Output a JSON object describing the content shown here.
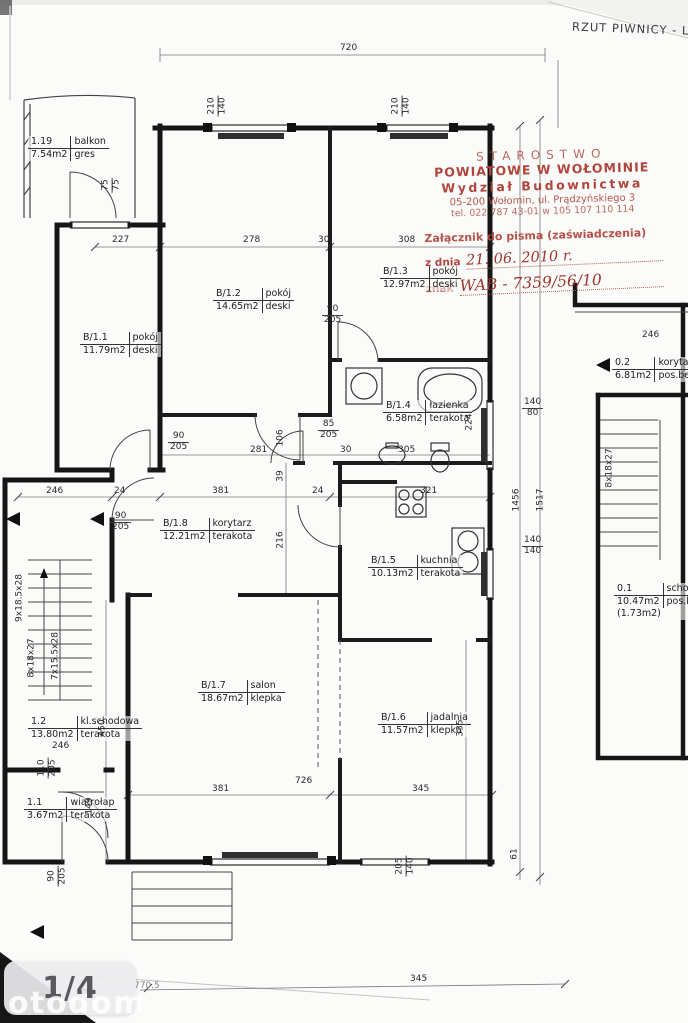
{
  "title": "RZUT PIWNICY - LOK.",
  "stamp": {
    "line1": "STAROSTWO",
    "line2": "POWIATOWE W WOŁOMINIE",
    "line3": "Wydział Budownictwa",
    "line4": "05-200 Wołomin, ul. Prądzyńskiego 3",
    "line5": "tel. 022 787 43-01 w 105 107 110 114",
    "attachment": "Załącznik do pisma (zaświadczenia)",
    "date_label": "z dnia",
    "date_value": "21. 06. 2010 r.",
    "ref_label": "znak",
    "ref_value": "WAB - 7359/56/10"
  },
  "rooms": [
    {
      "id": "1.19",
      "name": "balkon",
      "area": "7.54m2",
      "floor": "gres"
    },
    {
      "id": "B/1.1",
      "name": "pokój",
      "area": "11.79m2",
      "floor": "deski"
    },
    {
      "id": "B/1.2",
      "name": "pokój",
      "area": "14.65m2",
      "floor": "deski"
    },
    {
      "id": "B/1.3",
      "name": "pokój",
      "area": "12.97m2",
      "floor": "deski"
    },
    {
      "id": "B/1.4",
      "name": "łazienka",
      "area": "6.58m2",
      "floor": "terakota"
    },
    {
      "id": "B/1.8",
      "name": "korytarz",
      "area": "12.21m2",
      "floor": "terakota"
    },
    {
      "id": "B/1.5",
      "name": "kuchnia",
      "area": "10.13m2",
      "floor": "terakota"
    },
    {
      "id": "B/1.7",
      "name": "salon",
      "area": "18.67m2",
      "floor": "klepka"
    },
    {
      "id": "B/1.6",
      "name": "jadalnia",
      "area": "11.57m2",
      "floor": "klepka"
    },
    {
      "id": "1.2",
      "name": "kl.schodowa",
      "area": "13.80m2",
      "floor": "terakota"
    },
    {
      "id": "1.1",
      "name": "wiatrołap",
      "area": "3.67m2",
      "floor": "terakota"
    },
    {
      "id": "0.2",
      "name": "korytarz",
      "area": "6.81m2",
      "floor": "pos.bet."
    },
    {
      "id": "0.1",
      "name": "schowek",
      "area": "10.47m2",
      "floor": "pos.bet.",
      "extra": "(1.73m2)"
    }
  ],
  "dims": [
    "720",
    "210",
    "140",
    "210",
    "140",
    "75",
    "75",
    "227",
    "278",
    "30",
    "308",
    "90",
    "205",
    "224",
    "90",
    "205",
    "281",
    "85",
    "205",
    "106",
    "30",
    "305",
    "39",
    "140",
    "80",
    "140",
    "140",
    "1456",
    "1517",
    "246",
    "24",
    "381",
    "24",
    "321",
    "90",
    "205",
    "216",
    "450",
    "335",
    "246",
    "110",
    "205",
    "149",
    "381",
    "726",
    "345",
    "205",
    "140",
    "90",
    "205",
    "61",
    "246",
    "345",
    "770.5"
  ],
  "stairs_labels": [
    "9x18.5x28",
    "8x18x27",
    "7x15.5x28",
    "8x18x27"
  ],
  "footer": {
    "page": "1/4",
    "watermark": "otodom"
  },
  "colors": {
    "stamp_red": "#b0453c",
    "wall": "#161616",
    "paper": "#fbfbfa"
  }
}
